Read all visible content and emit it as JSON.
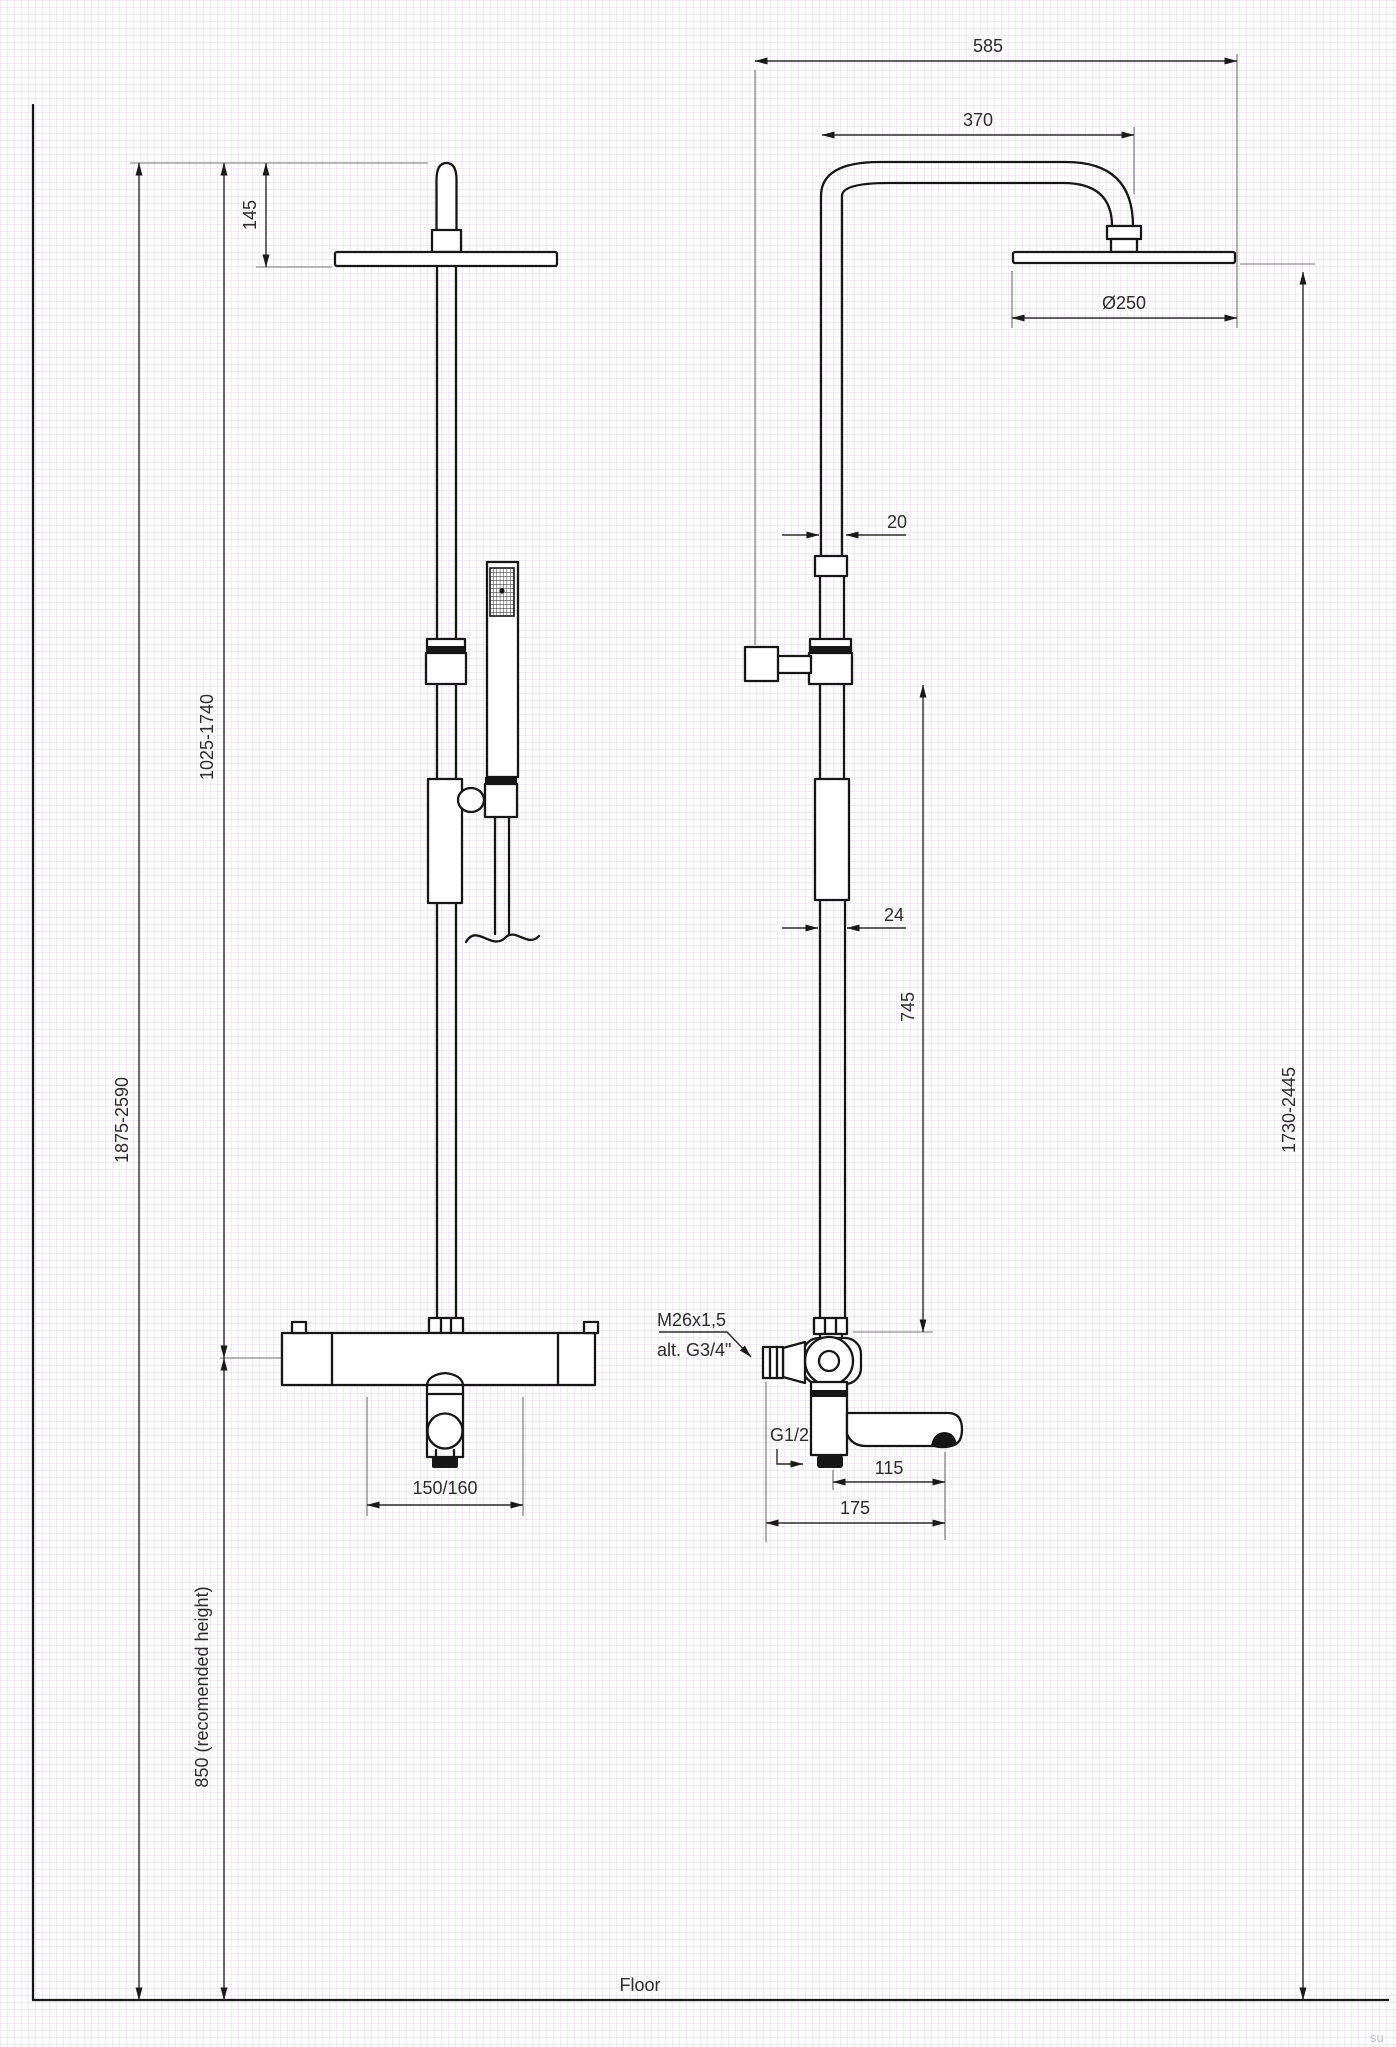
{
  "drawing": {
    "floor_label": "Floor",
    "watermark": "su",
    "colors": {
      "line": "#161616",
      "dim_text": "#2b2b2b",
      "reference_gray": "#8f8f8f",
      "grid": "#e0d6e4",
      "background": "#ffffff",
      "watermark": "#c0c0c8"
    },
    "front_view": {
      "dim_head_to_top": "145",
      "dim_column_adjust": "1025-1740",
      "dim_total_height": "1875-2590",
      "dim_mixer_height": "850 (recomended height)",
      "dim_hose_centers": "150/160"
    },
    "side_view": {
      "dim_total_reach": "585",
      "dim_arm_reach": "370",
      "dim_head_diameter": "Ø250",
      "dim_upper_tube": "20",
      "dim_lower_tube": "24",
      "dim_bracket_to_valve": "745",
      "dim_head_height": "1730-2445",
      "dim_spout_reach": "115",
      "dim_total_depth": "175",
      "note_thread_top": "M26x1,5",
      "note_thread_alt": "alt. G3/4\"",
      "note_outlet_thread": "G1/2"
    }
  }
}
